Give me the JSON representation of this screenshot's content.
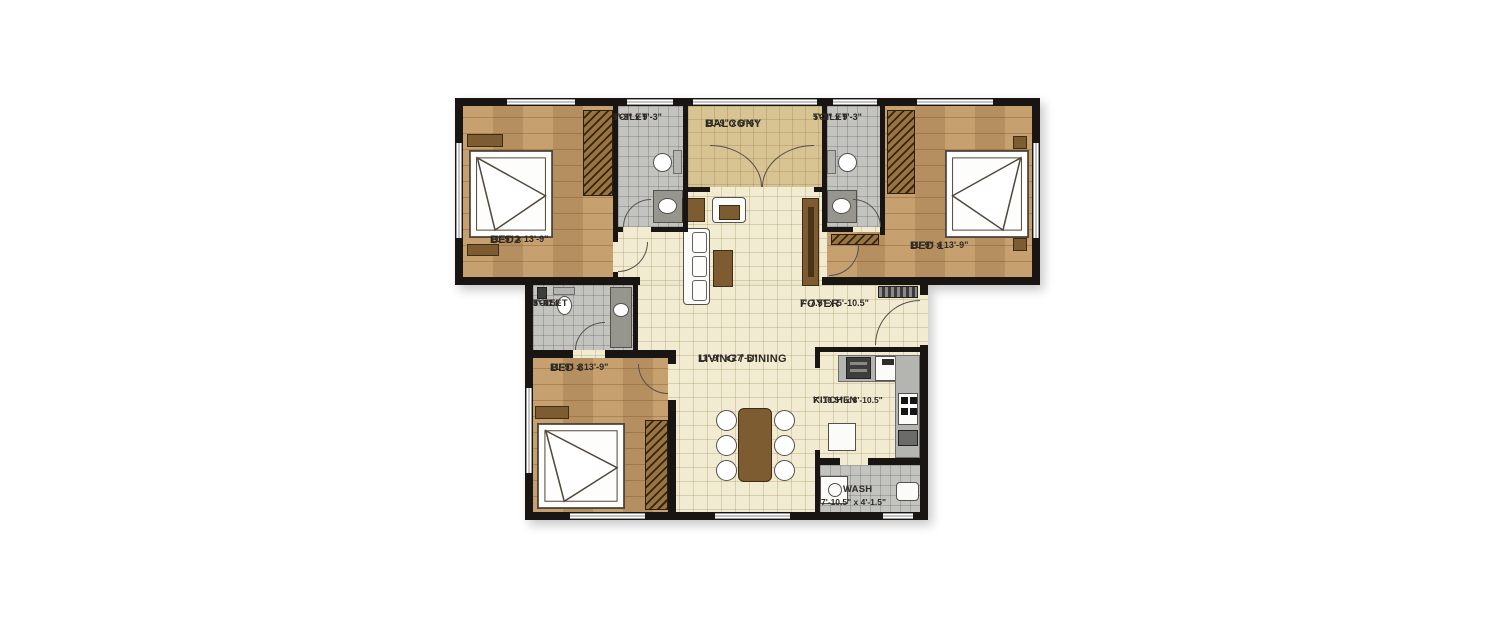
{
  "plan_title": "3 BHK Floor Plan",
  "rooms": {
    "bed2": {
      "label": "BED2",
      "dims": "11'-9\" x 13'-9\""
    },
    "toilet_top_left": {
      "label": "TOILET",
      "dims": "5'-3\" x 9'-3\""
    },
    "balcony": {
      "label": "BALCONY",
      "dims": "11'-9\" x 6'-6\""
    },
    "toilet_top_right": {
      "label": "TOILET",
      "dims": "5'-3\" x 9'-3\""
    },
    "bed1": {
      "label": "BED 1",
      "dims": "11'-9\" x 13'-9\""
    },
    "toilet_mid_left": {
      "label": "TOILET",
      "dims_line1": "8'-0\" x",
      "dims_line2": "5'-4.5\""
    },
    "bed3": {
      "label": "BED 3",
      "dims": "11'-9\" x 13'-9\""
    },
    "living_dining": {
      "label": "LIVING / DINING",
      "dims": "11'-9\" x 27'-6\""
    },
    "foyer": {
      "label": "FOYER",
      "dims": "7'-7.5\" x 5'-10.5\""
    },
    "kitchen": {
      "label": "KITCHEN",
      "dims": "7'-10.5\" x 8'-10.5\""
    },
    "wash": {
      "label": "WASH",
      "dims": "7'-10.5\" x 4'-1.5\""
    }
  },
  "colors": {
    "wall": "#191512",
    "bedroom_floor": "#c49a67",
    "living_floor": "#f1ebd1",
    "toilet_floor": "#c3c3c0",
    "balcony_floor": "#d8c393",
    "furniture_wood": "#7d5c31",
    "label_text": "#2e2a25"
  }
}
